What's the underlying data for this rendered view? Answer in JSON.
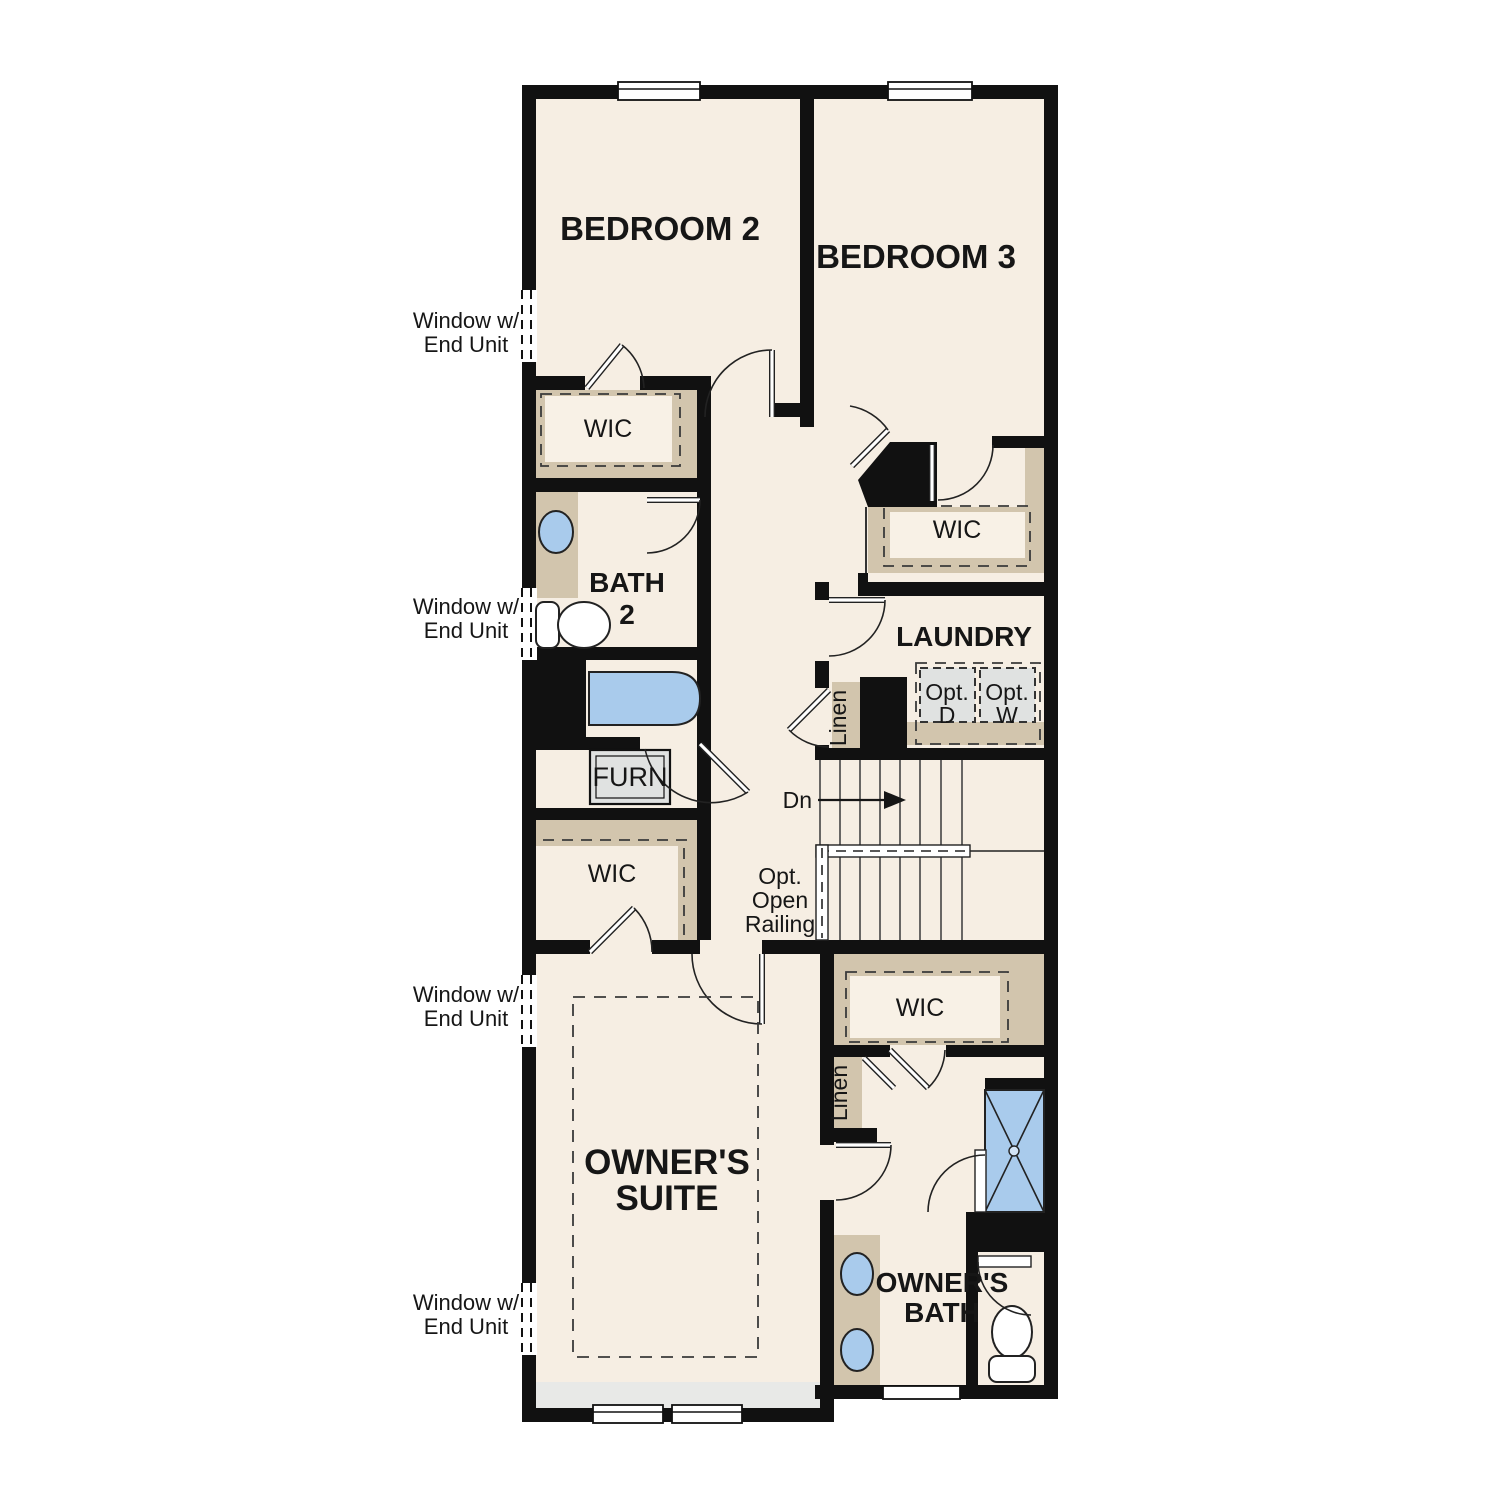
{
  "plan_type": "floor-plan",
  "colors": {
    "wall": "#111111",
    "floor": "#f6eee3",
    "closet_shelf": "#d2c5ad",
    "fixture_blue": "#a9cbec",
    "optional_box_gray": "#e0e2e1",
    "window_seat_strip": "#e8e9e7",
    "background": "#ffffff"
  },
  "rooms": {
    "bedroom2": "BEDROOM 2",
    "bedroom3": "BEDROOM 3",
    "laundry": "LAUNDRY",
    "bath2_line1": "BATH",
    "bath2_line2": "2",
    "owners_suite_line1": "OWNER'S",
    "owners_suite_line2": "SUITE",
    "owners_bath_line1": "OWNER'S",
    "owners_bath_line2": "BATH"
  },
  "closets": {
    "wic": "WIC",
    "linen": "Linen"
  },
  "labels": {
    "furnace": "FURN",
    "stairs_down": "Dn",
    "opt_dryer_line1": "Opt.",
    "opt_dryer_line2": "D",
    "opt_washer_line1": "Opt.",
    "opt_washer_line2": "W",
    "railing_line1": "Opt.",
    "railing_line2": "Open",
    "railing_line3": "Railing",
    "window_note_line1": "Window w/",
    "window_note_line2": "End Unit"
  }
}
